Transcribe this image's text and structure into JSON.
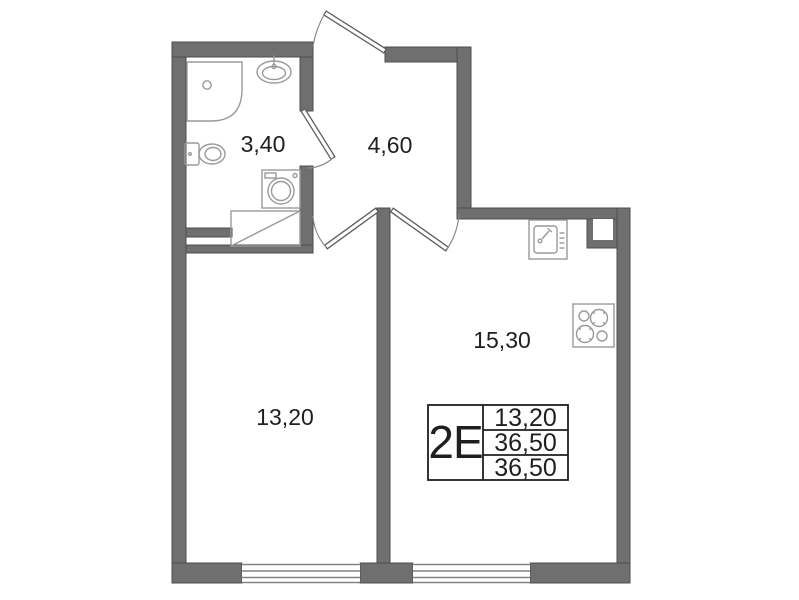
{
  "floor_plan": {
    "rooms": [
      {
        "name": "bathroom",
        "area": "3,40"
      },
      {
        "name": "hallway",
        "area": "4,60"
      },
      {
        "name": "living-room",
        "area": "13,20"
      },
      {
        "name": "kitchen-living",
        "area": "15,30"
      }
    ],
    "info_table": {
      "apartment_type": "2Е",
      "values": [
        "13,20",
        "36,50",
        "36,50"
      ]
    },
    "fixtures": [
      "shower-icon",
      "washbasin-icon",
      "toilet-icon",
      "washing-machine-icon",
      "wardrobe-icon",
      "kitchen-sink-icon",
      "stove-icon",
      "vent-shaft-icon",
      "window-icon",
      "door-swing-icon"
    ],
    "colors": {
      "wall": "#6f6f6f",
      "wall_edge": "#4d4d4d",
      "fixture_line": "#9a9a9a",
      "text": "#1f1f1f",
      "background": "#ffffff"
    }
  }
}
